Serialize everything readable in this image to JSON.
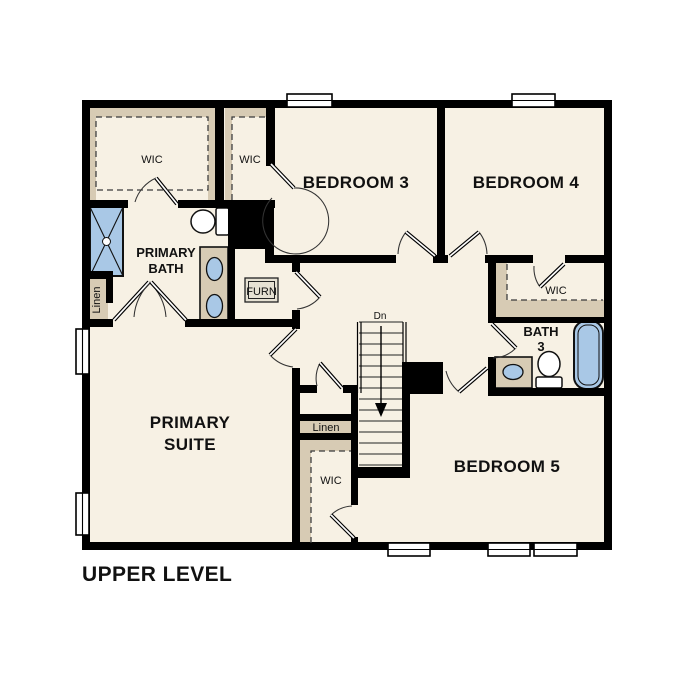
{
  "labels": {
    "title": "UPPER LEVEL",
    "wic_primary": "WIC",
    "wic_bed3": "WIC",
    "bedroom3": "BEDROOM 3",
    "bedroom4": "BEDROOM 4",
    "bedroom5": "BEDROOM 5",
    "primary_bath_1": "PRIMARY",
    "primary_bath_2": "BATH",
    "primary_suite_1": "PRIMARY",
    "primary_suite_2": "SUITE",
    "bath3_1": "BATH",
    "bath3_2": "3",
    "wic_bed4": "WIC",
    "wic_bed5": "WIC",
    "linen_bath": "Linen",
    "linen_hall": "Linen",
    "furnace": "FURN",
    "stairs_down": "Dn"
  },
  "colors": {
    "room_fill": "#f7f1e4",
    "closet_fill": "#d7cbb4",
    "fixture_blue": "#a9c8e6",
    "wall": "#000000"
  }
}
